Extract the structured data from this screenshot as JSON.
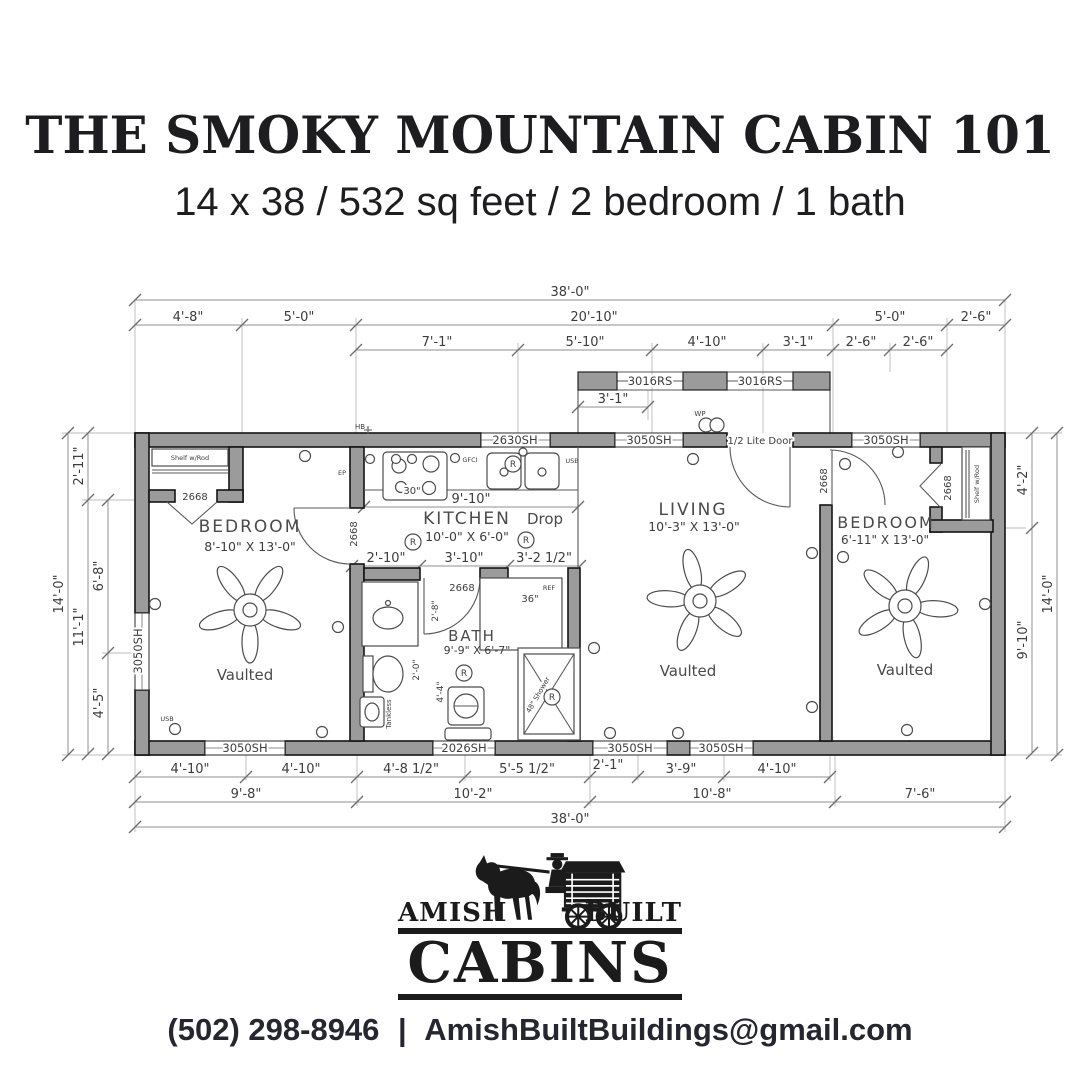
{
  "header": {
    "title": "THE SMOKY MOUNTAIN CABIN 101",
    "subtitle": "14 x 38 / 532 sq feet / 2 bedroom / 1 bath"
  },
  "plan": {
    "dims": {
      "overall": "38'-0\"",
      "top2": [
        "4'-8\"",
        "5'-0\"",
        "20'-10\"",
        "5'-0\"",
        "2'-6\""
      ],
      "top3": [
        "7'-1\"",
        "5'-10\"",
        "4'-10\"",
        "3'-1\"",
        "2'-6\"",
        "2'-6\""
      ],
      "porch": "3'-1\"",
      "bottom1": [
        "4'-10\"",
        "4'-10\"",
        "4'-8 1/2\"",
        "5'-5 1/2\"",
        "2'-1\"",
        "3'-9\"",
        "4'-10\""
      ],
      "bottom2": [
        "9'-8\"",
        "10'-2\"",
        "10'-8\"",
        "7'-6\""
      ],
      "left": {
        "a": "2'-11\"",
        "b": "6'-8\"",
        "c": "11'-1\"",
        "d": "4'-5\"",
        "overall": "14'-0\""
      },
      "right": {
        "a": "4'-2\"",
        "b": "9'-10\"",
        "overall": "14'-0\""
      },
      "kitchen_width": "9'-10\"",
      "mid": [
        "2'-10\"",
        "3'-10\"",
        "3'-2 1/2\""
      ],
      "bath_door": "2'-8\"",
      "bath_a": "2'-0\"",
      "bath_b": "4'-4\""
    },
    "windows": {
      "w3050": "3050SH",
      "w2630": "2630SH",
      "w2026": "2026SH",
      "w3016": "3016RS"
    },
    "doors": {
      "interior": "2668",
      "entry": "1/2 Lite Door"
    },
    "rooms": {
      "bed1": {
        "name": "BEDROOM",
        "size": "8'-10\" X 13'-0\"",
        "ceiling": "Vaulted"
      },
      "kitchen": {
        "name": "KITCHEN",
        "size": "10'-0\" X 6'-0\""
      },
      "bath": {
        "name": "BATH",
        "size": "9'-9\" X 6'-7\""
      },
      "living": {
        "name": "LIVING",
        "size": "10'-3\" X 13'-0\"",
        "ceiling": "Vaulted"
      },
      "bed2": {
        "name": "BEDROOM",
        "size": "6'-11\" X 13'-0\"",
        "ceiling": "Vaulted"
      }
    },
    "labels": {
      "shelf": "Shelf w/Rod",
      "drop": "Drop",
      "ref": "REF",
      "ref_size": "36\"",
      "tankless": "Tankless",
      "shower": "48\" Shower",
      "stove": "30\"",
      "gfci": "GFCI",
      "usb": "USB",
      "wp": "WP",
      "hb": "HB",
      "ep": "EP",
      "r": "R"
    }
  },
  "logo": {
    "amish": "AMISH",
    "built": "BUILT",
    "cabins": "CABINS"
  },
  "contact": {
    "phone": "(502) 298-8946",
    "separator": "|",
    "email": "AmishBuiltBuildings@gmail.com"
  }
}
